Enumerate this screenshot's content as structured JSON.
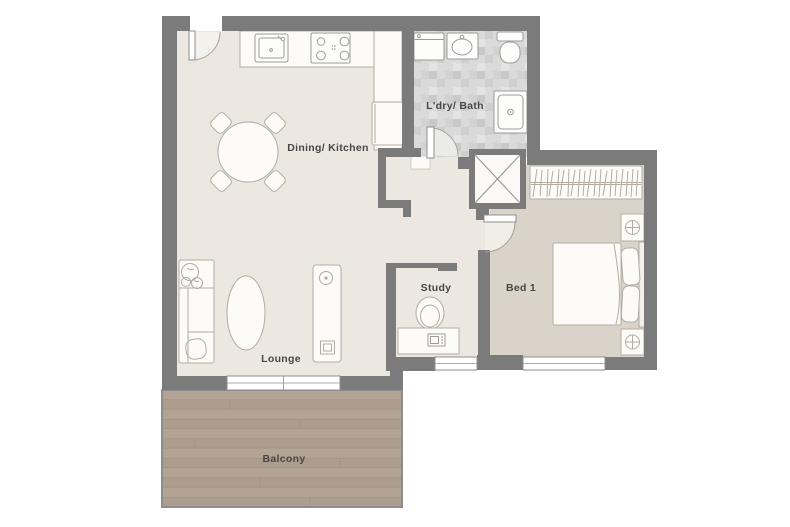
{
  "plan": {
    "rooms": {
      "dining_kitchen": {
        "label": "Dining/ Kitchen"
      },
      "ldry_bath": {
        "label": "L'dry/ Bath"
      },
      "bed1": {
        "label": "Bed 1"
      },
      "study": {
        "label": "Study"
      },
      "lounge": {
        "label": "Lounge"
      },
      "balcony": {
        "label": "Balcony"
      }
    },
    "colors": {
      "wall": "#7b7b7b",
      "floor-main": "#ece7e1",
      "floor-bed": "#d9d3ca",
      "floor-bath": "#dadada",
      "floor-balcony": "#ac9d8f",
      "balcony-stripe": "#9c8d7f",
      "furniture-fill": "#fcfbf8",
      "furniture-line": "#b2aca3",
      "fixture-line": "#9c9c9c",
      "window-line": "#8f8f8f",
      "label-text": "#474747"
    }
  }
}
